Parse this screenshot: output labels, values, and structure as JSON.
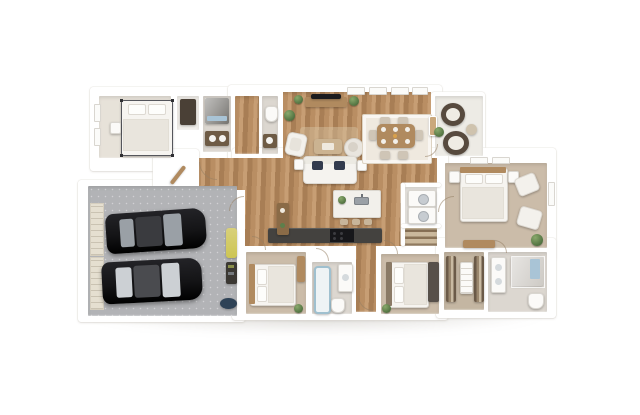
{
  "scene": {
    "description": "3D dollhouse-style overhead rendering of a single-story house floor plan on a white background",
    "render_style": "photoreal isometric top-down 3D floor plan"
  },
  "colors": {
    "wall": "#ffffff",
    "wood": "#b98e63",
    "wood_light": "#c79e74",
    "wood_dark": "#a87e55",
    "wood_furniture": "#b08a5f",
    "carpet": "#cbbca9",
    "carpet_light": "#e7e2d9",
    "tile": "#dcd7d0",
    "concrete": "#edebe5",
    "garage_floor": "#b2b3b6",
    "garage_door": "#e5dfd0",
    "car_body": "#141416",
    "car_glass": "#9aa0a6",
    "car_glass_light": "#ccd0d4",
    "plant": "#4e6f3e",
    "towel_blue": "#a9c4d6",
    "rug": "#efe9df",
    "counter_dark": "#44423f",
    "navy_pillow": "#323b4e",
    "closet_dark": "#4a4036",
    "heater_yellow": "#cdc553"
  },
  "floorplan": {
    "stats": {
      "bedrooms": 4,
      "bathrooms": 3,
      "garage_car_spaces": 2
    },
    "rooms": [
      {
        "name": "bedroom-top-left",
        "floor": "light carpet",
        "contents": [
          "metal-canopy-bed",
          "nightstand",
          "two-windows"
        ]
      },
      {
        "name": "closet-top-left",
        "floor": "white",
        "contents": [
          "dark-shelving"
        ]
      },
      {
        "name": "hall-bathroom-top",
        "floor": "tile",
        "contents": [
          "dark-shower",
          "blue-towel",
          "vanity"
        ]
      },
      {
        "name": "powder-room",
        "floor": "tile",
        "contents": [
          "toilet",
          "dark-vanity"
        ]
      },
      {
        "name": "entry-foyer",
        "floor": "wood",
        "contents": [
          "front-door",
          "door-swing"
        ]
      },
      {
        "name": "living-room",
        "floor": "wood",
        "contents": [
          "tv-console",
          "flat-tv",
          "sofa-with-navy-pillows",
          "coffee-table",
          "armchair",
          "round-swivel-chair",
          "area-rug",
          "potted-plants",
          "side-tables"
        ]
      },
      {
        "name": "dining-area",
        "floor": "wood",
        "contents": [
          "dining-table",
          "six-chairs",
          "white-rug",
          "three-windows",
          "wall-art"
        ]
      },
      {
        "name": "patio",
        "floor": "concrete",
        "contents": [
          "round-wicker-chair",
          "round-wicker-chair",
          "side-table",
          "plant"
        ]
      },
      {
        "name": "master-bedroom",
        "floor": "carpet",
        "contents": [
          "bed",
          "two-nightstands",
          "armchair",
          "lounge-chair",
          "dresser",
          "plant",
          "windows"
        ]
      },
      {
        "name": "kitchen",
        "floor": "wood",
        "contents": [
          "island-with-sink",
          "bar-stools",
          "counter-with-range",
          "hall-console"
        ]
      },
      {
        "name": "laundry-pantry",
        "floor": "tile",
        "contents": [
          "stacked-washer-dryer",
          "pantry-shelves"
        ]
      },
      {
        "name": "garage",
        "floor": "speckled concrete",
        "contents": [
          "black-car",
          "black-car",
          "double-garage-doors",
          "water-heater",
          "storage-shelf",
          "floor-mat"
        ]
      },
      {
        "name": "bedroom-bottom-left",
        "floor": "carpet",
        "contents": [
          "bed",
          "tall-dresser",
          "plant"
        ]
      },
      {
        "name": "hall-bathroom-bottom",
        "floor": "tile",
        "contents": [
          "bathtub",
          "toilet",
          "vanity"
        ]
      },
      {
        "name": "bedroom-bottom-right",
        "floor": "carpet",
        "contents": [
          "bed",
          "dark-wardrobe",
          "plant"
        ]
      },
      {
        "name": "walk-in-closet",
        "floor": "carpet",
        "contents": [
          "hanging-clothes-left",
          "hanging-clothes-right",
          "shelf-tower"
        ]
      },
      {
        "name": "master-bathroom",
        "floor": "tile",
        "contents": [
          "vanity",
          "glass-shower",
          "blue-towel",
          "toilet"
        ]
      }
    ]
  }
}
